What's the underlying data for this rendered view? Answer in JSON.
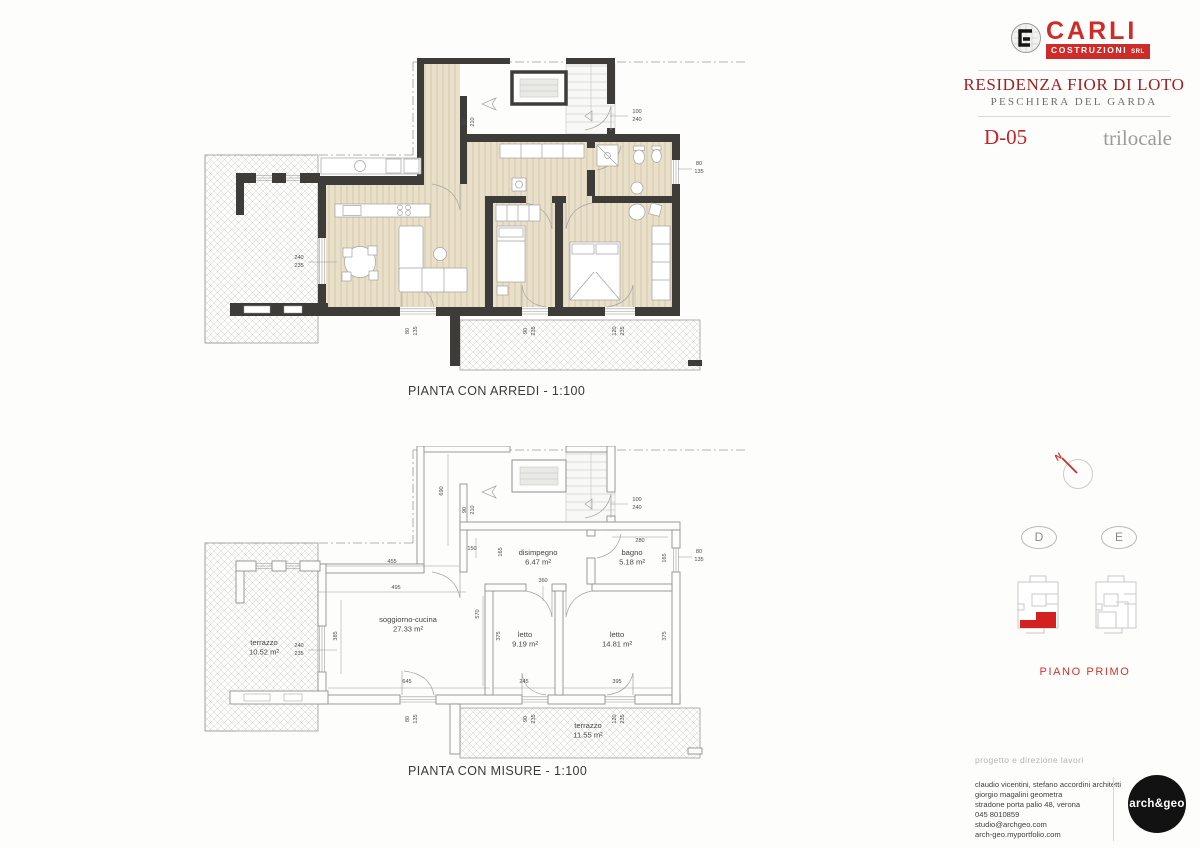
{
  "header": {
    "logo": {
      "mark": "C",
      "name": "CARLI",
      "sub": "COSTRUZIONI",
      "srl": "SRL"
    },
    "title": "RESIDENZA FIOR DI LOTO",
    "subtitle": "PESCHIERA DEL GARDA",
    "unit_code": "D-05",
    "unit_type": "trilocale",
    "accent_red": "#cf2b28",
    "title_red": "#a31f24"
  },
  "captions": {
    "arredi": "PIANTA CON ARREDI - 1:100",
    "misure": "PIANTA CON MISURE - 1:100"
  },
  "key": {
    "north": "N",
    "blocks": [
      "D",
      "E"
    ],
    "floor_label": "PIANO PRIMO",
    "highlight_red": "#d42020"
  },
  "credits": {
    "heading": "progetto e direzione lavori",
    "lines": [
      "claudio vicentini, stefano accordini architetti",
      "giorgio magalini geometra",
      "stradone porta palio 48, verona",
      "045 8010859",
      "studio@archgeo.com",
      "arch-geo.myportfolio.com"
    ],
    "studio": "arch&geo"
  },
  "plan": {
    "rooms": [
      {
        "name": "terrazzo",
        "area": "10.52 m²",
        "x": 64,
        "y": 199
      },
      {
        "name": "soggiorno-cucina",
        "area": "27.33 m²",
        "x": 208,
        "y": 176
      },
      {
        "name": "disimpegno",
        "area": "6.47 m²",
        "x": 338,
        "y": 109
      },
      {
        "name": "bagno",
        "area": "5.18 m²",
        "x": 432,
        "y": 109
      },
      {
        "name": "letto",
        "area": "9.19 m²",
        "x": 325,
        "y": 191
      },
      {
        "name": "letto",
        "area": "14.81 m²",
        "x": 417,
        "y": 191
      },
      {
        "name": "terrazzo",
        "area": "11.55 m²",
        "x": 388,
        "y": 282
      }
    ],
    "dims_shared": [
      {
        "x": 99,
        "y": 201,
        "t": "240"
      },
      {
        "x": 99,
        "y": 209,
        "t": "235"
      },
      {
        "x": 266,
        "y": 64,
        "t": "90",
        "r": 1
      },
      {
        "x": 274,
        "y": 64,
        "t": "210",
        "r": 1
      },
      {
        "x": 437,
        "y": 55,
        "t": "100"
      },
      {
        "x": 437,
        "y": 63,
        "t": "240"
      },
      {
        "x": 499,
        "y": 107,
        "t": "80"
      },
      {
        "x": 499,
        "y": 115,
        "t": "135"
      },
      {
        "x": 209,
        "y": 273,
        "t": "80",
        "r": 1
      },
      {
        "x": 217,
        "y": 273,
        "t": "135",
        "r": 1
      },
      {
        "x": 327,
        "y": 273,
        "t": "90",
        "r": 1
      },
      {
        "x": 335,
        "y": 273,
        "t": "235",
        "r": 1
      },
      {
        "x": 416,
        "y": 273,
        "t": "120",
        "r": 1
      },
      {
        "x": 424,
        "y": 273,
        "t": "235",
        "r": 1
      }
    ],
    "dims_misure": [
      {
        "x": 192,
        "y": 117,
        "t": "455"
      },
      {
        "x": 196,
        "y": 143,
        "t": "495"
      },
      {
        "x": 137,
        "y": 190,
        "t": "385",
        "r": 1
      },
      {
        "x": 272,
        "y": 104,
        "t": "150"
      },
      {
        "x": 302,
        "y": 106,
        "t": "165",
        "r": 1
      },
      {
        "x": 343,
        "y": 136,
        "t": "360"
      },
      {
        "x": 279,
        "y": 168,
        "t": "570",
        "r": 1
      },
      {
        "x": 300,
        "y": 190,
        "t": "375",
        "r": 1
      },
      {
        "x": 466,
        "y": 190,
        "t": "375",
        "r": 1
      },
      {
        "x": 440,
        "y": 96,
        "t": "280"
      },
      {
        "x": 466,
        "y": 112,
        "t": "165",
        "r": 1
      },
      {
        "x": 207,
        "y": 237,
        "t": "645"
      },
      {
        "x": 324,
        "y": 237,
        "t": "245"
      },
      {
        "x": 417,
        "y": 237,
        "t": "395"
      },
      {
        "x": 243,
        "y": 45,
        "t": "690",
        "r": 1
      }
    ]
  }
}
